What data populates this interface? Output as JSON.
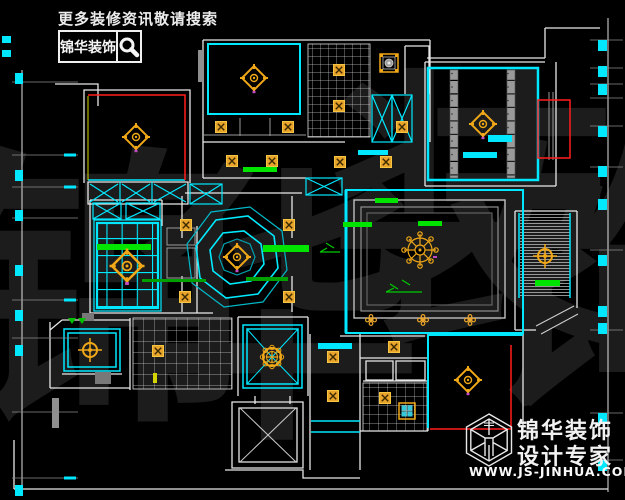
{
  "banner": {
    "text": "更多装修资讯敬请搜索"
  },
  "search_box": {
    "brand": "锦华装饰",
    "icon": "magnifier-icon"
  },
  "watermark": {
    "text": "锦华装饰",
    "chars": [
      "锦",
      "华",
      "装",
      "饰"
    ]
  },
  "logo": {
    "brand": "锦华装饰",
    "tagline": "设计专家",
    "url": "WWW.JS-JINHUA.COM",
    "icon": "hexagon-cube-logo"
  },
  "drawing": {
    "kind": "residential ceiling plan (CAD)",
    "symbols": [
      "diamond-ceiling-light",
      "crosshair-ceiling-light",
      "chandelier",
      "downlight-box",
      "flower-downlight",
      "ornate-square-lamp",
      "ornate-ceiling-light",
      "bath-heater",
      "wardrobe-x-box"
    ]
  },
  "palette": {
    "background": "#000000",
    "wall_white": "#e8e8e8",
    "ceiling_cyan": "#00e8ff",
    "accent_red": "#ff1d1d",
    "light_orange": "#e8a32a",
    "highlight_green": "#00e400",
    "dim_gray": "#9a9a9a",
    "watermark_gray": "#1c1c1c"
  }
}
